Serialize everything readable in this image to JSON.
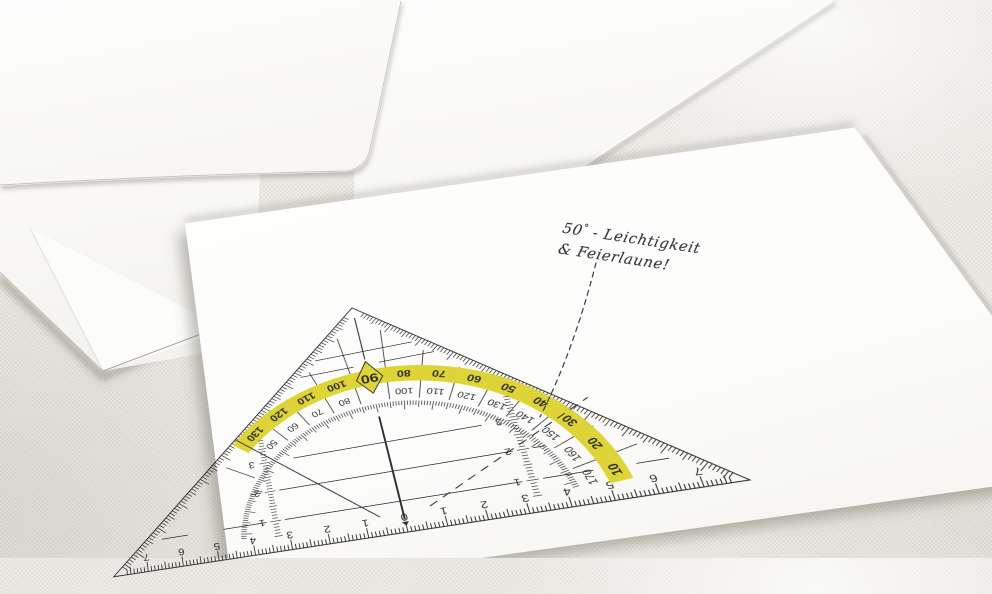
{
  "colors": {
    "fabric": "#eae7e1",
    "envelope_white": "#fbfaf8",
    "card_white": "#fcfcfb",
    "ink": "#26262a",
    "highlight_yellow": "#ddd22e",
    "handwriting_ink": "#35353c"
  },
  "handwriting": {
    "line1_number": "50",
    "line1_degree": "°",
    "line1_rest": " - Leichtigkeit",
    "line2": "& Feierlaune!"
  },
  "protractor": {
    "diamond_label": "90",
    "outer_labels": [
      {
        "a": 10,
        "t": "10"
      },
      {
        "a": 20,
        "t": "20"
      },
      {
        "a": 30,
        "t": "30"
      },
      {
        "a": 40,
        "t": "40"
      },
      {
        "a": 50,
        "t": "50"
      },
      {
        "a": 60,
        "t": "60"
      },
      {
        "a": 70,
        "t": "70"
      },
      {
        "a": 80,
        "t": "80"
      },
      {
        "a": 100,
        "t": "100"
      },
      {
        "a": 110,
        "t": "110"
      },
      {
        "a": 120,
        "t": "120"
      },
      {
        "a": 130,
        "t": "130"
      }
    ],
    "inner_labels": [
      {
        "a": 10,
        "t": "170"
      },
      {
        "a": 20,
        "t": "160"
      },
      {
        "a": 30,
        "t": "150"
      },
      {
        "a": 40,
        "t": "140"
      },
      {
        "a": 50,
        "t": "130"
      },
      {
        "a": 60,
        "t": "120"
      },
      {
        "a": 70,
        "t": "110"
      },
      {
        "a": 80,
        "t": "100"
      },
      {
        "a": 100,
        "t": "80"
      },
      {
        "a": 110,
        "t": "70"
      },
      {
        "a": 120,
        "t": "60"
      },
      {
        "a": 130,
        "t": "50"
      }
    ],
    "ruler_zero": "0",
    "ruler_numbers": [
      "1",
      "2",
      "3",
      "4",
      "5",
      "6",
      "7"
    ],
    "parallel_labels": [
      "1",
      "2",
      "3"
    ]
  }
}
